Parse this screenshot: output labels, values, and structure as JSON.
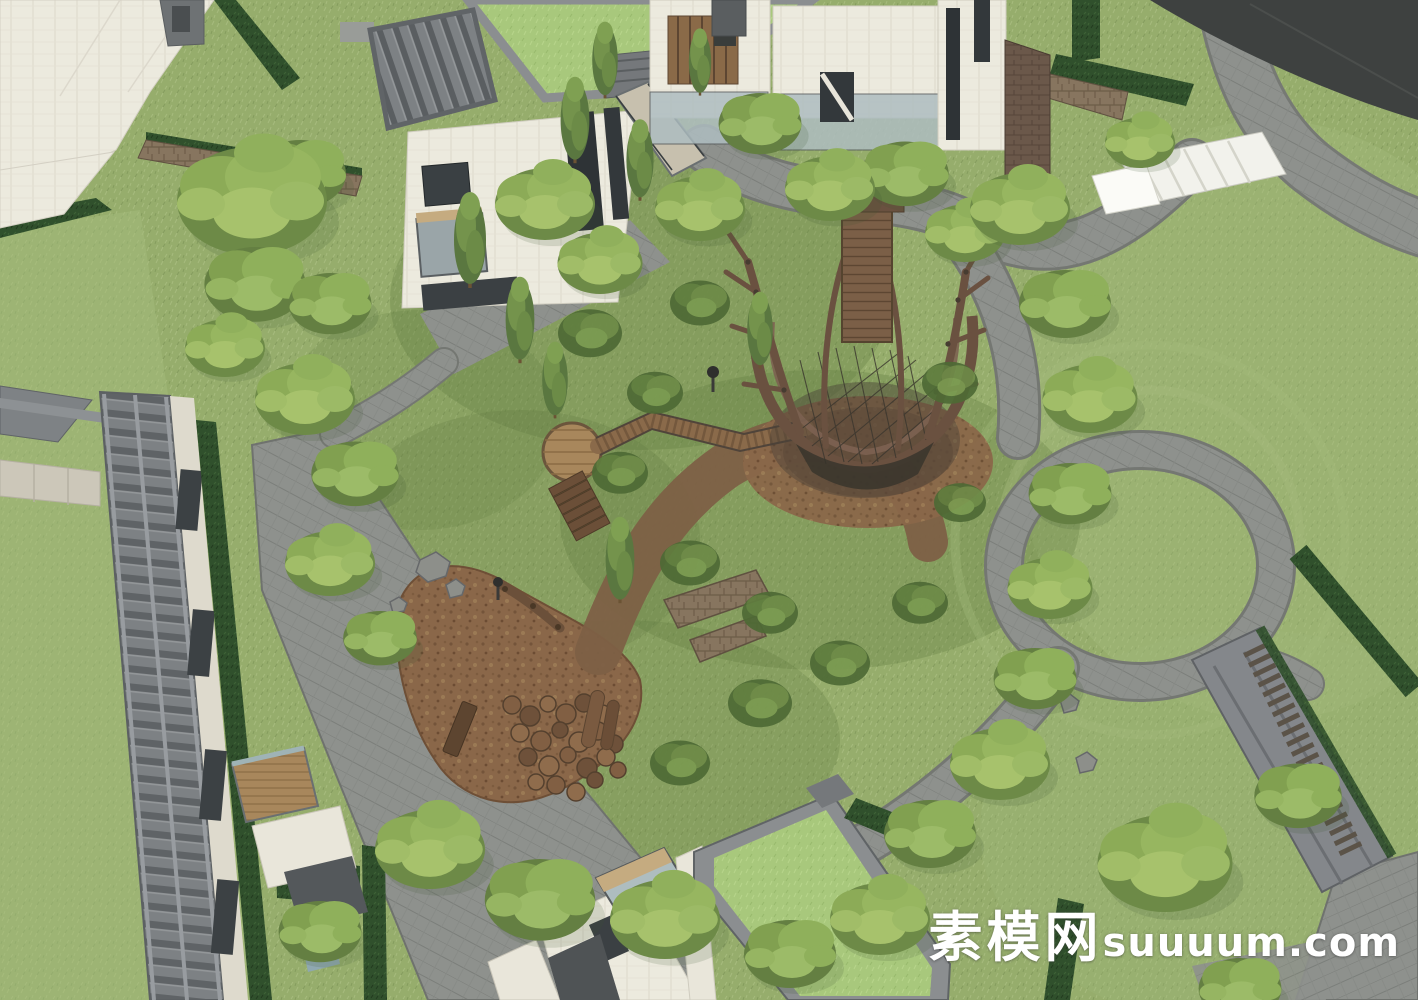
{
  "scene": {
    "title": "Residential landscape aerial rendering",
    "description": "SketchUp-style aerial 3D rendering of a modern residential courtyard: white villas with planted green roofs and grey timber pergolas surround a naturalistic play garden of pine trees, mulch play areas, log stepping stumps, a raised timber boardwalk and a large branch-built treehouse nest; grey paved paths, clipped dark hedges, rubble stone walls, white garden stairs and open lawns complete the site.",
    "style": "sketchup-render",
    "camera": "aerial-oblique"
  },
  "watermark": {
    "cn": "素模网",
    "en": "suuuum.com",
    "full": "素模网suuuum.com",
    "color": "#ffffff"
  },
  "palette": {
    "grass": "#96ad6c",
    "lawn_light": "#a3bb7c",
    "roof_lawn": "#a8c87c",
    "paving": "#8e918d",
    "road": "#3e4140",
    "building_white": "#eceade",
    "parapet": "#8b8e90",
    "pergola": "#7d8184",
    "hedge": "#30502c",
    "stone_wall": "#87755f",
    "mulch": "#8a6749",
    "timber": "#7b5f47",
    "treehouse": "#6a5140",
    "glass": "#aebdc0",
    "foliage": "#8fae59",
    "foliage_light": "#a9c46e",
    "foliage_dark": "#4e6a35"
  },
  "features": [
    "white villa buildings",
    "green planted roofs",
    "timber pergola roof",
    "treehouse play nest",
    "timber boardwalk and round deck",
    "log stepping stumps",
    "mulch playground",
    "grey paved paths",
    "dark clipped hedges",
    "rubble stone retaining walls",
    "white garden stairs",
    "open lawns",
    "pine trees"
  ]
}
